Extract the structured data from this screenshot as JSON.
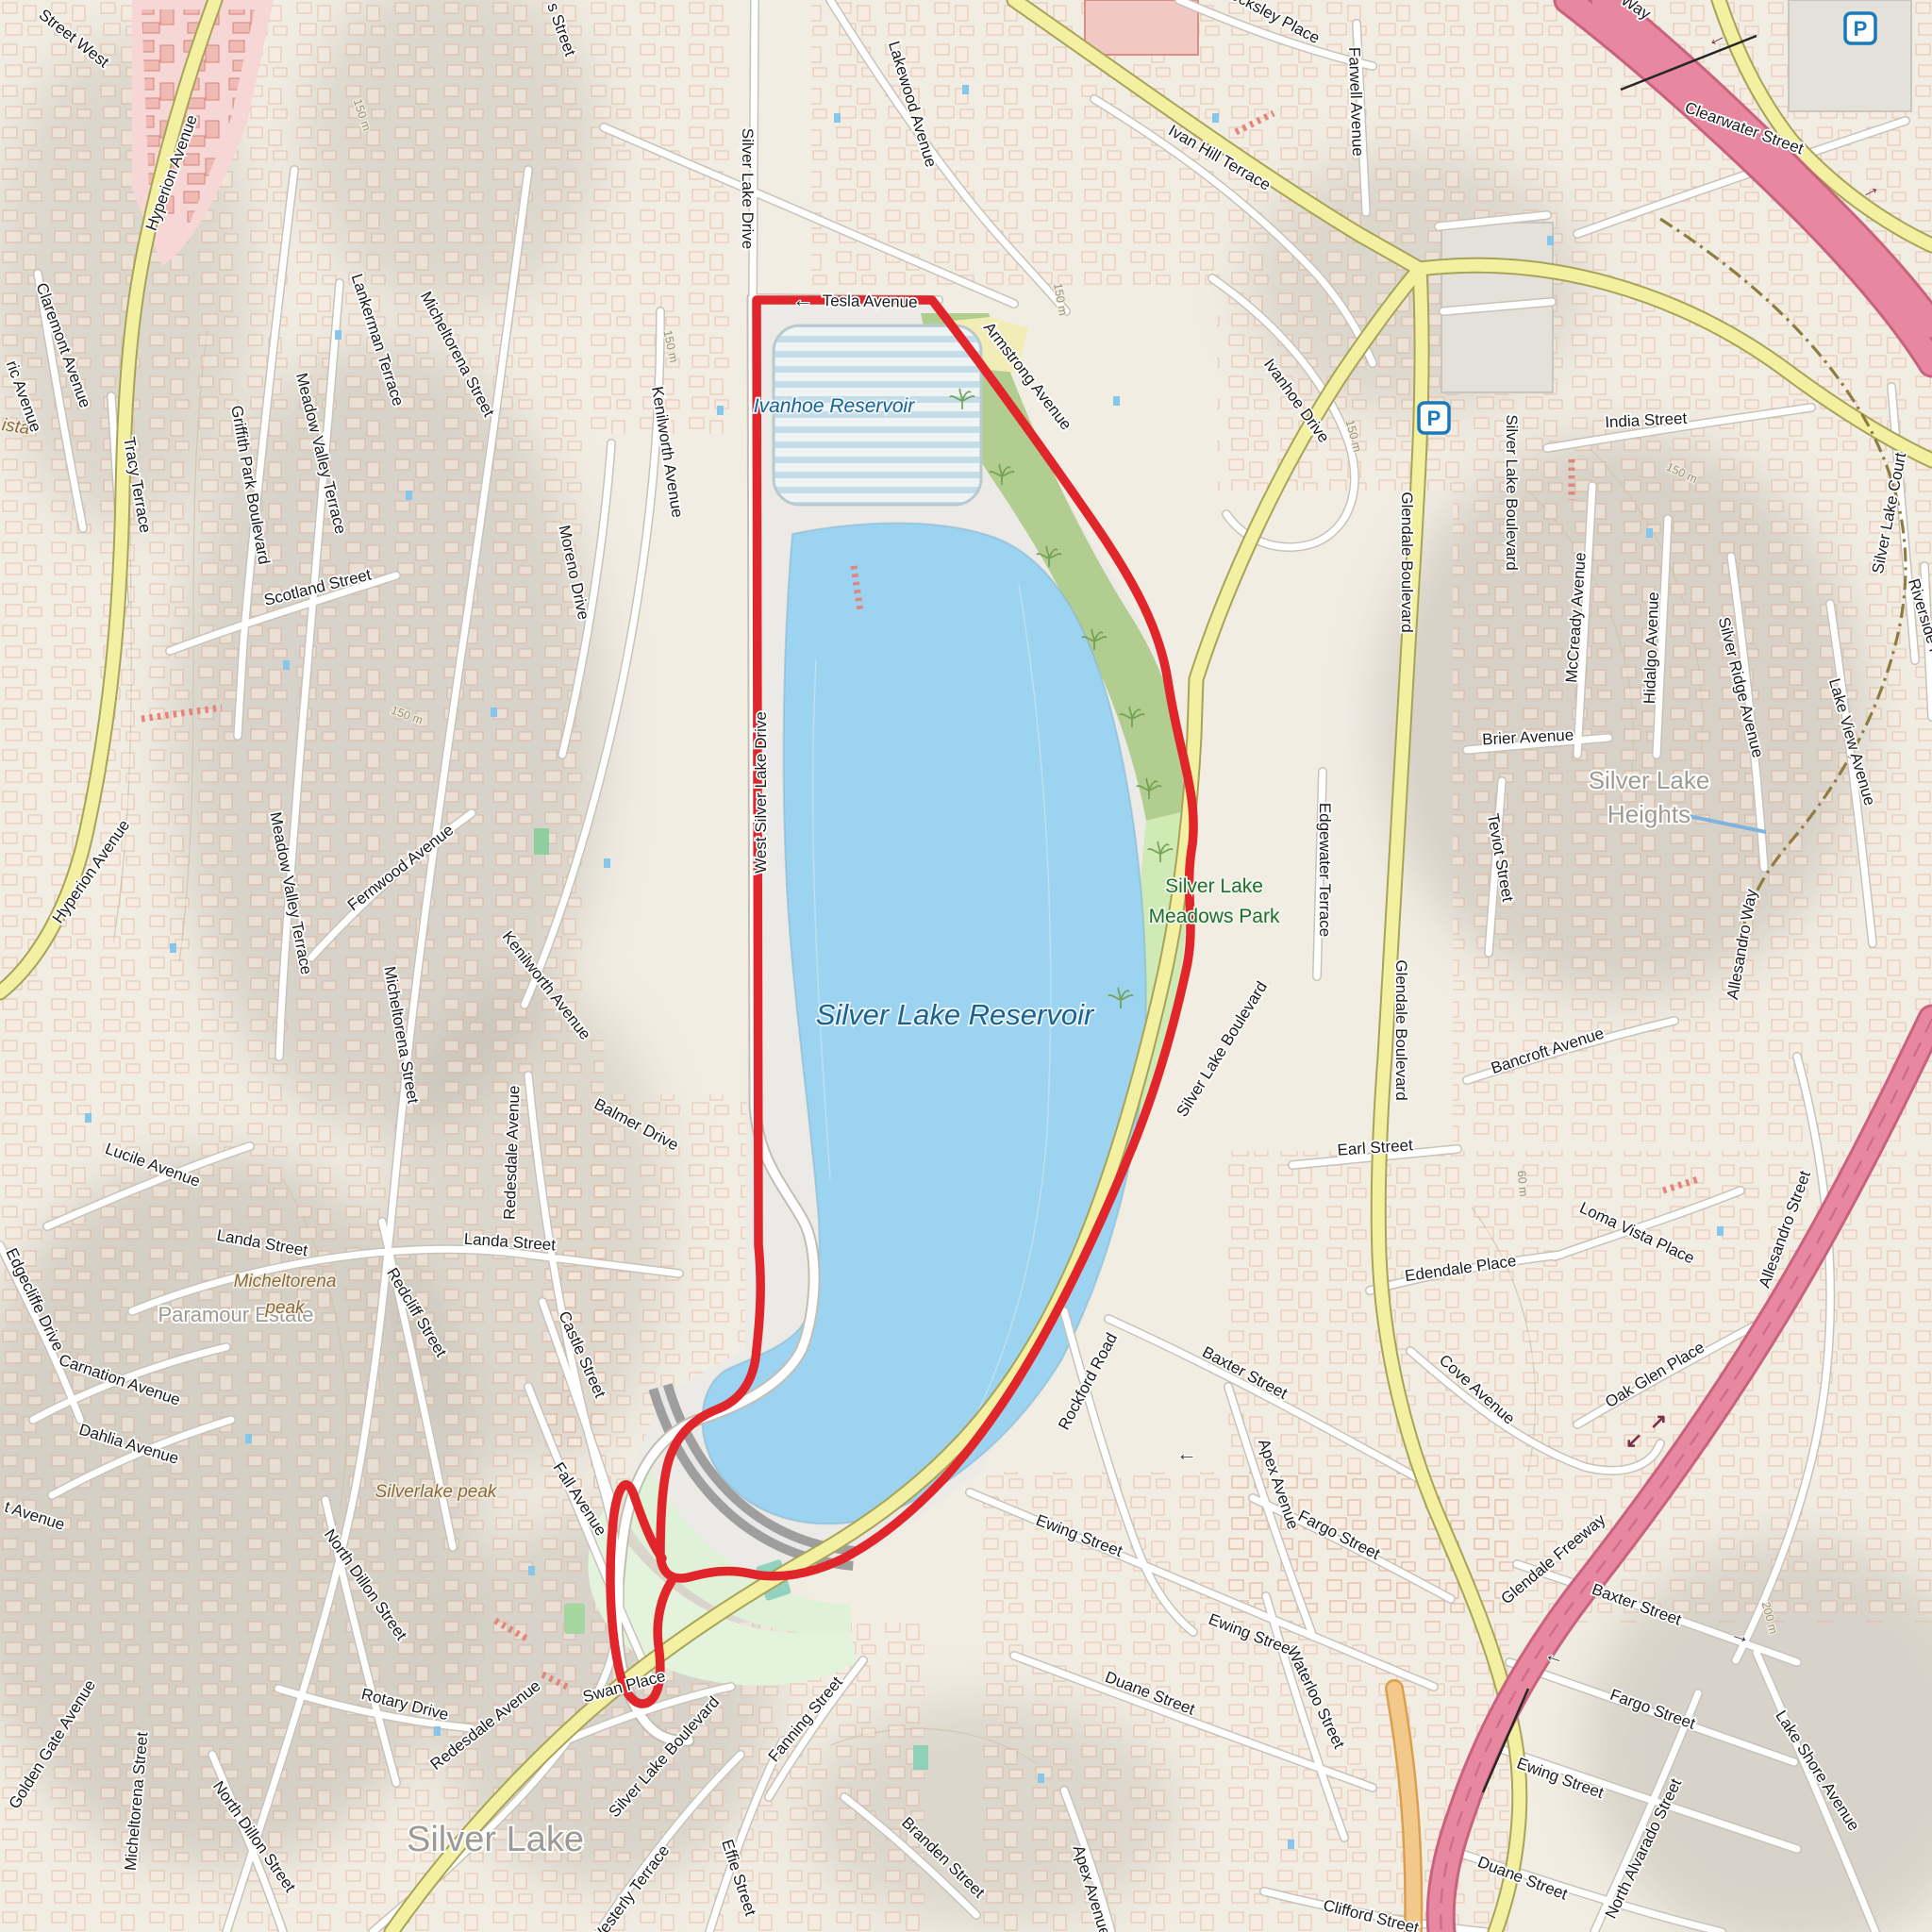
{
  "map_title": "Silver Lake Reservoir loop map",
  "colors": {
    "background": "#f2ede3",
    "water": "#9bd3f0",
    "reservoir_stripes": "#c4dde8",
    "park_green": "#b2cd90",
    "meadow_green": "#cfeab4",
    "lawn_green": "#dff2d8",
    "road_yellow": "#f3f0a2",
    "freeway_pink": "#e787a0",
    "ramp_orange": "#f3c98b",
    "route_red": "#e0262b",
    "building_outline": "#dca88c",
    "hillshade_gray": "#aaa49b",
    "label_gray": "#9a9a9a",
    "water_label_blue": "#1a6392",
    "park_label_green": "#256c33",
    "peak_label_brown": "#8a6a3e",
    "parking_blue": "#1a7ab8"
  },
  "water": {
    "silver_lake_reservoir": "Silver Lake Reservoir",
    "ivanhoe_reservoir": "Ivanhoe Reservoir"
  },
  "parks": {
    "meadows_line1": "Silver Lake",
    "meadows_line2": "Meadows Park"
  },
  "areas": {
    "silver_lake": "Silver Lake",
    "heights_line1": "Silver Lake",
    "heights_line2": "Heights",
    "paramour_estate": "Paramour Estate",
    "ista_partial": "ista"
  },
  "peaks": {
    "micheltorena_line1": "Micheltorena",
    "micheltorena_line2": "peak",
    "silverlake_peak": "Silverlake peak"
  },
  "contours": {
    "c150": "150 m",
    "c60": "60 m",
    "c200": "200 m"
  },
  "labels": {
    "street_west": "Street West",
    "s_street": "s Street",
    "hyperion": "Hyperion Avenue",
    "claremont": "Claremont Avenue",
    "ric_avenue": "ric Avenue",
    "tracy": "Tracy Terrace",
    "griffith_park": "Griffith Park Boulevard",
    "meadow_valley": "Meadow Valley Terrace",
    "scotland": "Scotland Street",
    "micheltorena": "Micheltorena Street",
    "lankerman": "Lankerman Terrace",
    "kenilworth": "Kenilworth Avenue",
    "moreno": "Moreno Drive",
    "fernwood": "Fernwood Avenue",
    "silver_lake_drive": "Silver Lake Drive",
    "west_silver_lake_drive": "West Silver Lake Drive",
    "lakewood": "Lakewood Avenue",
    "tesla": "Tesla Avenue",
    "armstrong": "Armstrong Avenue",
    "locksley": "Locksley Place",
    "ivan_hill": "Ivan Hill Terrace",
    "farwell": "Farwell Avenue",
    "ivanhoe_drive": "Ivanhoe Drive",
    "way_partial": "Way",
    "clearwater": "Clearwater Street",
    "india": "India Street",
    "silver_lake_blvd": "Silver Lake Boulevard",
    "mccready": "McCready Avenue",
    "hidalgo": "Hidalgo Avenue",
    "silver_ridge": "Silver Ridge Avenue",
    "lake_view": "Lake View Avenue",
    "silver_lake_court": "Silver Lake Court",
    "riverside": "Riverside Place",
    "brier": "Brier Avenue",
    "teviot": "Teviot Street",
    "edgewater": "Edgewater Terrace",
    "glendale_blvd": "Glendale Boulevard",
    "bancroft": "Bancroft Avenue",
    "earl": "Earl Street",
    "balmer": "Balmer Drive",
    "lucile": "Lucile Avenue",
    "landa": "Landa Street",
    "edgecliffe": "Edgecliffe Drive",
    "carnation": "Carnation Avenue",
    "dahlia": "Dahlia Avenue",
    "t_avenue": "t Avenue",
    "redcliff": "Redcliff Street",
    "castle": "Castle Street",
    "fall": "Fall Avenue",
    "north_dillon": "North Dillon Street",
    "rotary": "Rotary Drive",
    "redesdale": "Redesdale Avenue",
    "swan": "Swan Place",
    "golden_gate": "Golden Gate Avenue",
    "westerly": "Westerly Terrace",
    "fanning": "Fanning Street",
    "effie": "Effie Street",
    "rockford": "Rockford Road",
    "baxter": "Baxter Street",
    "apex": "Apex Avenue",
    "fargo": "Fargo Street",
    "ewing": "Ewing Street",
    "duane": "Duane Street",
    "waterloo": "Waterloo Street",
    "branden": "Branden Street",
    "clifford": "Clifford Street",
    "cove": "Cove Avenue",
    "edendale": "Edendale Place",
    "loma_vista": "Loma Vista Place",
    "oak_glen": "Oak Glen Place",
    "allesandro_way": "Allesandro Way",
    "allesandro_street": "Allesandro Street",
    "glendale_freeway": "Glendale Freeway",
    "lake_shore": "Lake Shore Avenue",
    "north_alvarado": "North Alvarado Street"
  },
  "icons": {
    "parking": "P",
    "arrow_left": "←",
    "arrow_right": "→",
    "arrow_up_right": "↗",
    "arrow_down_left": "↙"
  }
}
